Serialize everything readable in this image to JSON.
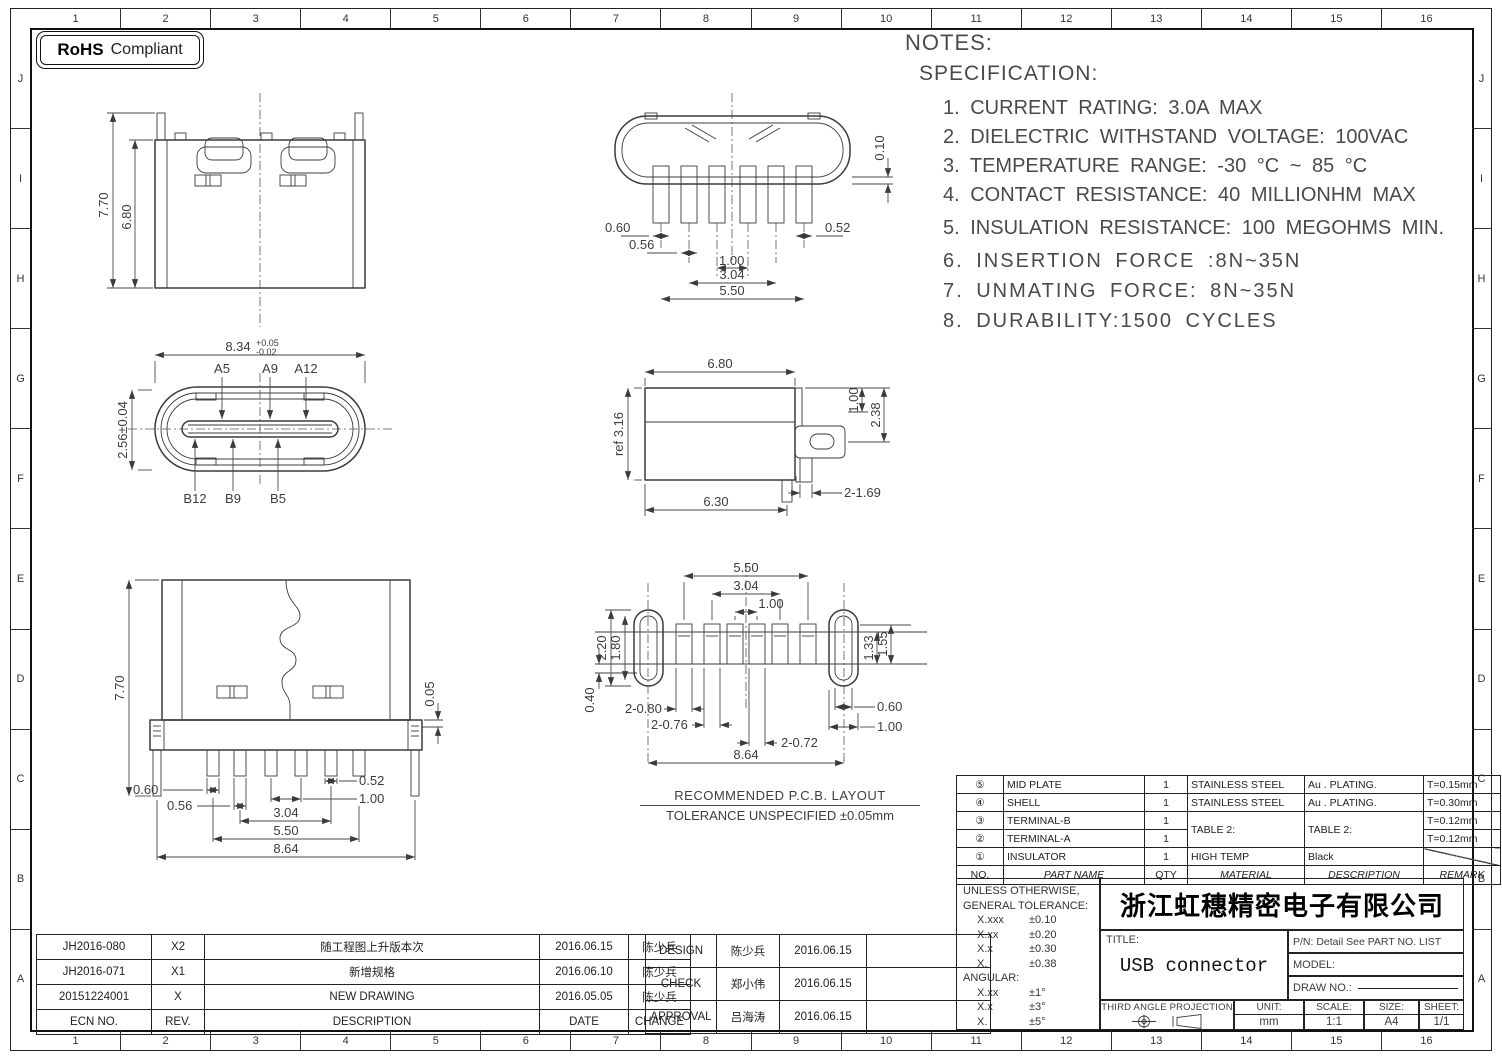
{
  "rohs": {
    "bold": "RoHS",
    "rest": "Compliant"
  },
  "border": {
    "columns": [
      "1",
      "2",
      "3",
      "4",
      "5",
      "6",
      "7",
      "8",
      "9",
      "10",
      "11",
      "12",
      "13",
      "14",
      "15",
      "16"
    ],
    "rows": [
      "J",
      "I",
      "H",
      "G",
      "F",
      "E",
      "D",
      "C",
      "B",
      "A"
    ]
  },
  "notes": {
    "title": "NOTES:",
    "subtitle": "SPECIFICATION:",
    "items": [
      "1.  CURRENT  RATING:  3.0A  MAX",
      "2.  DIELECTRIC  WITHSTAND  VOLTAGE:  100VAC",
      "3.  TEMPERATURE  RANGE:  -30 °C ~ 85 °C",
      "4.  CONTACT  RESISTANCE:  40  MILLIONHM  MAX",
      "5.  INSULATION  RESISTANCE:  100  MEGOHMS  MIN.",
      "6.  INSERTION  FORCE  :8N~35N",
      "7.  UNMATING  FORCE:  8N~35N",
      "8.  DURABILITY:1500  CYCLES"
    ]
  },
  "views": {
    "rear": {
      "h_total": "7.70",
      "h_body": "6.80"
    },
    "bottom_view": {
      "edge": "0.10",
      "p1": "0.60",
      "p2": "0.56",
      "pitch": "1.00",
      "p3": "0.52",
      "span": "3.04",
      "overall": "5.50"
    },
    "face": {
      "width": "8.34",
      "tol_plus": "+0.05",
      "tol_minus": "-0.02",
      "height": "2.56±0.04",
      "a5": "A5",
      "a9": "A9",
      "a12": "A12",
      "b12": "B12",
      "b9": "B9",
      "b5": "B5"
    },
    "side": {
      "top": "6.80",
      "ref": "ref 3.16",
      "d1": "1.00",
      "d2": "2.38",
      "bottom": "6.30",
      "legs": "2-1.69"
    },
    "front": {
      "h": "7.70",
      "offset": "0.05",
      "p1": "0.60",
      "p2": "0.56",
      "p3": "0.52",
      "pitch": "1.00",
      "span": "3.04",
      "row": "5.50",
      "overall": "8.64"
    },
    "pcb": {
      "row": "5.50",
      "span": "3.04",
      "pitch": "1.00",
      "hole_h": "2.20",
      "hole_i": "1.80",
      "gap": "0.40",
      "pad1": "2-0.80",
      "pad2": "2-0.76",
      "pad3": "2-0.72",
      "overall": "8.64",
      "pad_h1": "1.33",
      "pad_h2": "1.55",
      "hole_w": "0.60",
      "hole_w2": "1.00",
      "caption1": "RECOMMENDED   P.C.B.  LAYOUT",
      "caption2": "TOLERANCE  UNSPECIFIED  ±0.05mm"
    }
  },
  "parts_table": {
    "headers": {
      "no": "NO.",
      "name": "PART  NAME",
      "qty": "QTY",
      "material": "MATERIAL",
      "description": "DESCRIPTION",
      "remark": "REMARK"
    },
    "rows": [
      {
        "no": "⑤",
        "name": "MID  PLATE",
        "qty": "1",
        "material": "STAINLESS  STEEL",
        "description": "Au . PLATING.",
        "remark": "T=0.15mm"
      },
      {
        "no": "④",
        "name": "SHELL",
        "qty": "1",
        "material": "STAINLESS  STEEL",
        "description": "Au . PLATING.",
        "remark": "T=0.30mm"
      },
      {
        "no": "③",
        "name": "TERMINAL-B",
        "qty": "1",
        "material": "TABLE  2:",
        "description": "TABLE  2:",
        "remark": "T=0.12mm"
      },
      {
        "no": "②",
        "name": "TERMINAL-A",
        "qty": "1",
        "material": "",
        "description": "",
        "remark": "T=0.12mm"
      },
      {
        "no": "①",
        "name": "INSULATOR",
        "qty": "1",
        "material": "HIGH  TEMP",
        "description": "Black",
        "remark": ""
      }
    ]
  },
  "tolerances": {
    "line1": "UNLESS  OTHERWISE,",
    "line2": "GENERAL  TOLERANCE:",
    "rows": [
      {
        "k": "X.xxx",
        "v": "±0.10"
      },
      {
        "k": "X.xx",
        "v": "±0.20"
      },
      {
        "k": "X.x",
        "v": "±0.30"
      },
      {
        "k": "X.",
        "v": "±0.38"
      }
    ],
    "angular_label": "ANGULAR:",
    "angular_rows": [
      {
        "k": "X.xx",
        "v": "±1°"
      },
      {
        "k": "X.x",
        "v": "±3°"
      },
      {
        "k": "X.",
        "v": "±5°"
      }
    ]
  },
  "title_block": {
    "company": "浙江虹穗精密电子有限公司",
    "title_label": "TITLE:",
    "title_value": "USB connector",
    "pn": "P/N: Detail See PART NO. LIST",
    "model_label": "MODEL:",
    "draw_no_label": "DRAW NO.:",
    "projection_label": "THIRD ANGLE PROJECTION",
    "unit_label": "UNIT:",
    "unit_value": "mm",
    "scale_label": "SCALE:",
    "scale_value": "1:1",
    "size_label": "SIZE:",
    "size_value": "A4",
    "sheet_label": "SHEET:",
    "sheet_value": "1/1"
  },
  "revision_table": {
    "headers": {
      "ecn": "ECN  NO.",
      "rev": "REV.",
      "desc": "DESCRIPTION",
      "date": "DATE",
      "by": "CHANGE"
    },
    "rows": [
      {
        "ecn": "JH2016-080",
        "rev": "X2",
        "desc": "随工程图上升版本次",
        "date": "2016.06.15",
        "by": "陈少兵"
      },
      {
        "ecn": "JH2016-071",
        "rev": "X1",
        "desc": "新增规格",
        "date": "2016.06.10",
        "by": "陈少兵"
      },
      {
        "ecn": "20151224001",
        "rev": "X",
        "desc": "NEW  DRAWING",
        "date": "2016.05.05",
        "by": "陈少兵"
      }
    ]
  },
  "approval_table": {
    "rows": [
      {
        "role": "DESIGN",
        "name": "陈少兵",
        "date": "2016.06.15"
      },
      {
        "role": "CHECK",
        "name": "郑小伟",
        "date": "2016.06.15"
      },
      {
        "role": "APPROVAL",
        "name": "吕海涛",
        "date": "2016.06.15"
      }
    ]
  }
}
